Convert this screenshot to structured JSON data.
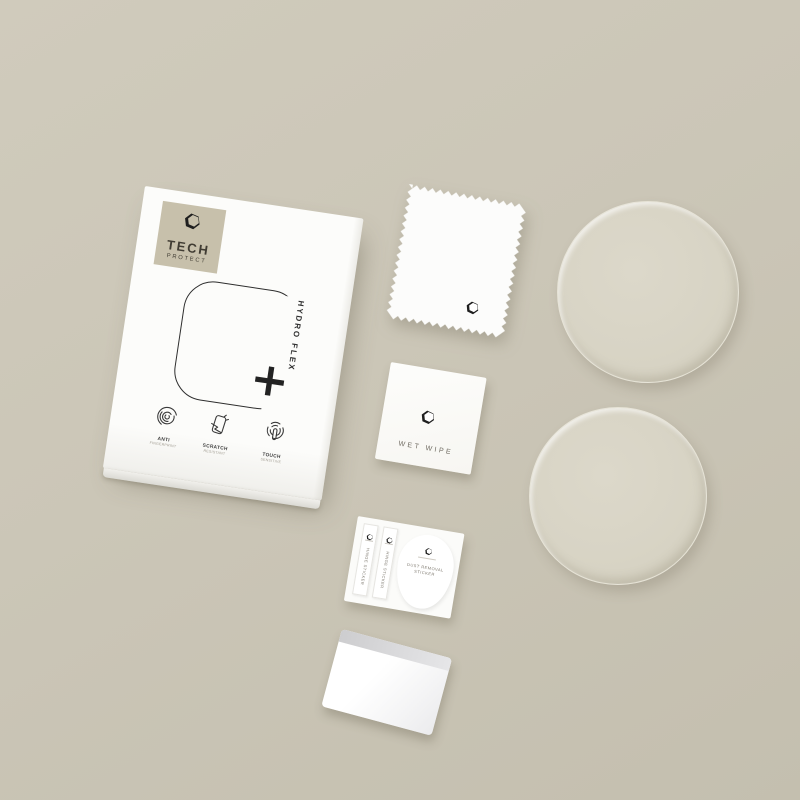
{
  "colors": {
    "background": "#cbc6b7",
    "item_white": "#fcfcfa",
    "logo_patch_tan": "#c7c0ab",
    "ink": "#2e2e2e",
    "film_tint": "#d9d5c6"
  },
  "box": {
    "brand": {
      "line1": "TECH",
      "line2": "PROTECT"
    },
    "product_label": "HYDRO FLEX",
    "plus_symbol": "+",
    "features": [
      {
        "icon": "fingerprint-icon",
        "title": "ANTI",
        "subtitle": "FINGERPRINT"
      },
      {
        "icon": "scratch-icon",
        "title": "SCRATCH",
        "subtitle": "RESISTANT"
      },
      {
        "icon": "touch-icon",
        "title": "TOUCH",
        "subtitle": "SENSITIVE"
      }
    ]
  },
  "accessories": {
    "wet_wipe": {
      "label": "WET WIPE"
    },
    "sticker_card": {
      "strips": [
        {
          "label": "HINGE STICKER"
        },
        {
          "label": "HINGE STICKER"
        }
      ],
      "dust_removal": {
        "line1": "DUST REMOVAL",
        "line2": "STICKER"
      }
    },
    "films": {
      "count": 2,
      "shape": "round"
    }
  },
  "icons": {
    "brand-logo": "hexagon ring",
    "fingerprint-icon": "fingerprint whorl arcs",
    "scratch-icon": "phone screen with scratch",
    "touch-icon": "fingertip with radiating rings"
  }
}
